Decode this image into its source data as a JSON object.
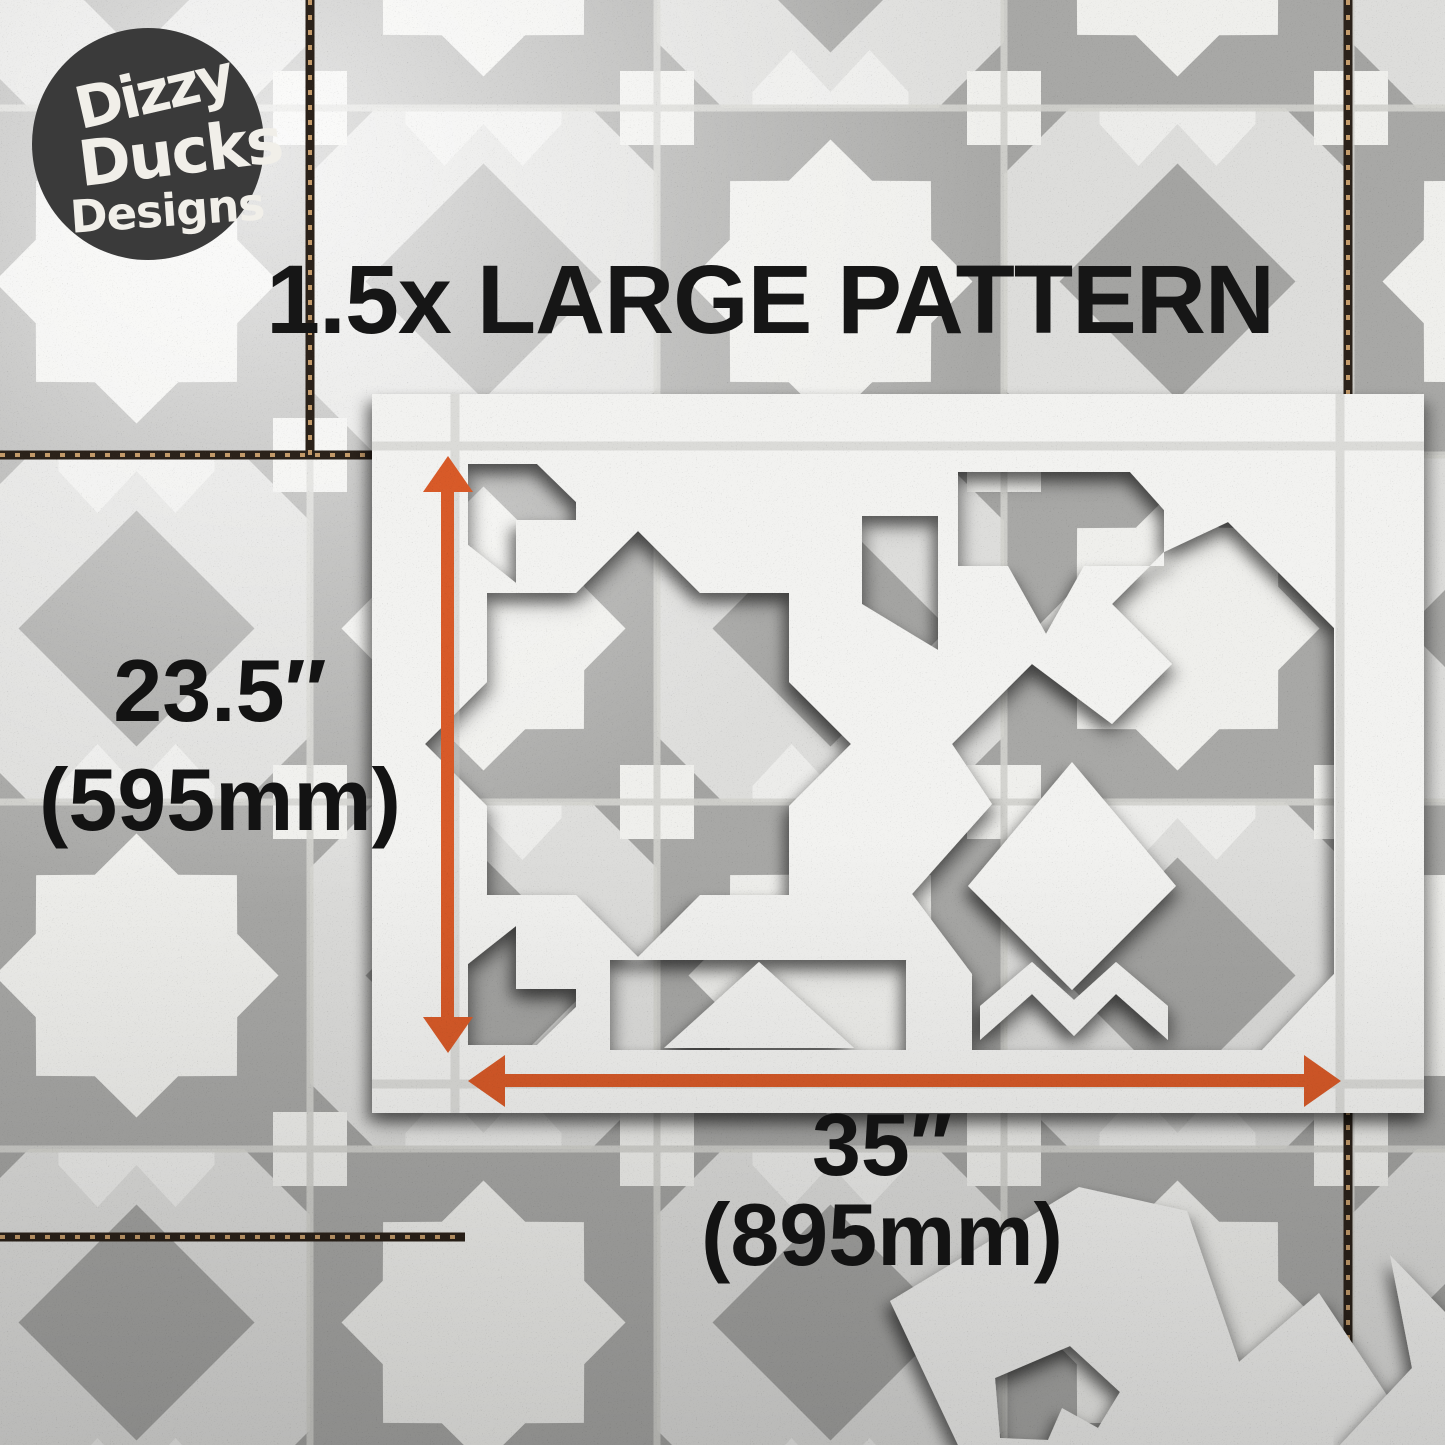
{
  "image": {
    "width": 1445,
    "height": 1445,
    "subject": "1.5x large pattern tile stencil on patterned tile floor"
  },
  "logo": {
    "line1": "Dizzy",
    "line2": "Ducks",
    "line3": "Designs"
  },
  "title": "1.5x LARGE PATTERN",
  "dimensions": {
    "height": {
      "inches": "23.5″",
      "mm": "(595mm)"
    },
    "width": {
      "inches": "35″",
      "mm": "(895mm)"
    }
  },
  "colors": {
    "arrow": "#d85a28",
    "logo_bg": "#3a3a3a",
    "text": "#161616",
    "stencil_white": "#f2f2f0",
    "tile_grey": "#a8a8a6",
    "grout_dark": "#2b221a",
    "grout_gold": "#c49b6a"
  }
}
